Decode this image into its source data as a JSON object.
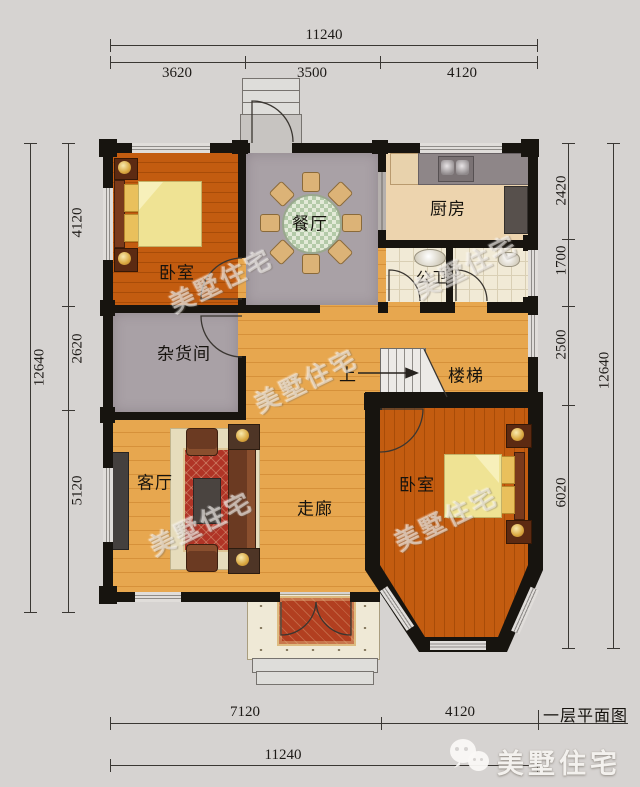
{
  "caption": "一层平面图",
  "brand": {
    "name": "美墅住宅"
  },
  "watermark": "美墅住宅",
  "rooms": {
    "bedroom_top": "卧室",
    "dining": "餐厅",
    "kitchen": "厨房",
    "bathroom": "公卫",
    "storage": "杂货间",
    "living": "客厅",
    "corridor": "走廊",
    "bedroom_bottom": "卧室",
    "stairs": "楼梯",
    "stairs_up": "上"
  },
  "dimensions": {
    "top": {
      "total": "11240",
      "segments": [
        "3620",
        "3500",
        "4120"
      ]
    },
    "bottom": {
      "segments": [
        "7120",
        "4120"
      ],
      "total": "11240"
    },
    "left": {
      "total": "12640",
      "segments": [
        "4120",
        "2620",
        "5120"
      ]
    },
    "right": {
      "segments": [
        "2420",
        "1700",
        "2500",
        "6020"
      ],
      "total": "12640"
    }
  },
  "colors": {
    "background": "#d6d3d1",
    "wall": "#17140f",
    "bedroom_wood": "#c35c10",
    "corridor_wood": "#e7a74f",
    "gray_floor": "#a9a1a6",
    "kitchen_floor": "#edd4ae",
    "tile_floor": "#f1ead6",
    "carpet_red": "#b03426",
    "bedding_yellow": "#efe394"
  }
}
